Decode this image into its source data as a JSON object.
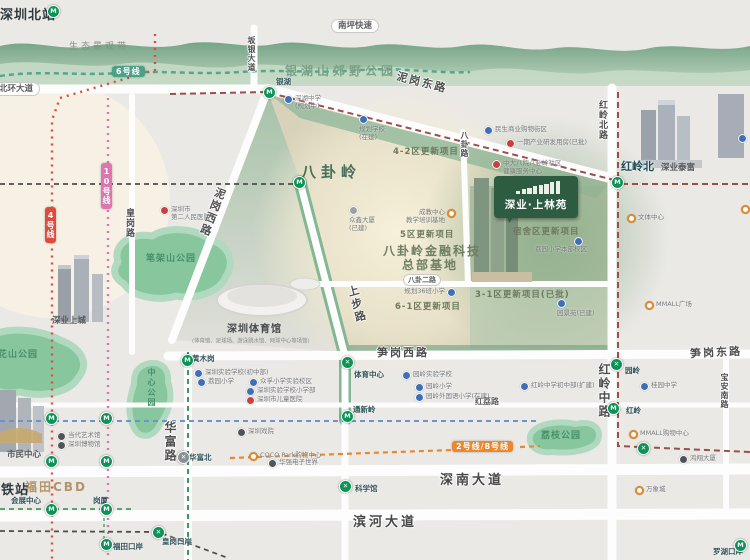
{
  "banner": {
    "title": "深业·上林苑"
  },
  "icons": {
    "glyphs": {
      "m": "M",
      "x": "✕",
      "xg": "✕"
    }
  },
  "badges": [
    {
      "name": "line-6-badge",
      "label": "6号线",
      "x": 112,
      "y": 66,
      "bg": "#4aa183",
      "vert": false
    },
    {
      "name": "line-4-badge",
      "label": "4号线",
      "x": 45,
      "y": 207,
      "bg": "#df4b3d",
      "vert": true
    },
    {
      "name": "line-10-badge",
      "label": "10号线",
      "x": 101,
      "y": 163,
      "bg": "#dd76b0",
      "vert": true
    },
    {
      "name": "line-2-8-badge",
      "label": "2号线/8号线",
      "x": 452,
      "y": 441,
      "bg": "#e8882f",
      "vert": false
    }
  ],
  "labels": [
    {
      "name": "road-nanping-expressway",
      "label": "南坪快速",
      "x": 331,
      "y": 19,
      "cls": "cap"
    },
    {
      "name": "road-beihuan-avenue",
      "label": "北环大道",
      "x": -8,
      "y": 82,
      "cls": "cap"
    },
    {
      "name": "road-banyin-avenue",
      "label": "坂银大道",
      "x": 246,
      "y": 36,
      "cls": "rv rvsm"
    },
    {
      "name": "road-nigang-east",
      "label": "泥岗东路",
      "x": 396,
      "y": 74,
      "cls": "rbig rotNE"
    },
    {
      "name": "road-nigang-west",
      "label": "泥岗西路",
      "x": 204,
      "y": 186,
      "cls": "rbig rotNW"
    },
    {
      "name": "road-huanggang",
      "label": "皇岗路",
      "x": 123,
      "y": 208,
      "cls": "rv"
    },
    {
      "name": "road-hongling-north",
      "label": "红岭北路",
      "x": 596,
      "y": 100,
      "cls": "rv"
    },
    {
      "name": "road-bagua",
      "label": "八卦路",
      "x": 459,
      "y": 131,
      "cls": "rv rvsm"
    },
    {
      "name": "road-bagua-2nd",
      "label": "八卦二路",
      "x": 403,
      "y": 274,
      "cls": "cap capsm"
    },
    {
      "name": "road-shangbu",
      "label": "上步路",
      "x": 348,
      "y": 285,
      "cls": "rbig rotSB"
    },
    {
      "name": "road-sungang-west",
      "label": "笋岗西路",
      "x": 377,
      "y": 344,
      "cls": "rbig"
    },
    {
      "name": "road-sungang-east",
      "label": "笋岗东路",
      "x": 690,
      "y": 344,
      "cls": "rbig rotm3"
    },
    {
      "name": "road-huafu",
      "label": "华富路",
      "x": 162,
      "y": 421,
      "cls": "rv rvbig"
    },
    {
      "name": "road-hongli",
      "label": "红荔路",
      "x": 475,
      "y": 396,
      "cls": "rsm"
    },
    {
      "name": "road-hongling-middle",
      "label": "红岭中路",
      "x": 596,
      "y": 363,
      "cls": "rv rvbig"
    },
    {
      "name": "road-baoan-south",
      "label": "宝安南路",
      "x": 719,
      "y": 373,
      "cls": "rv rvsm"
    },
    {
      "name": "road-shennan-avenue",
      "label": "深南大道",
      "x": 440,
      "y": 469,
      "cls": "rbig rxl"
    },
    {
      "name": "road-binhe-avenue",
      "label": "滨河大道",
      "x": 353,
      "y": 511,
      "cls": "rbig rxl"
    },
    {
      "name": "shenzhen-north-station",
      "label": "深圳北站",
      "x": 0,
      "y": 4,
      "cls": "citybig"
    },
    {
      "name": "eco-landscape-belt",
      "label": "生态景观带",
      "x": 69,
      "y": 39,
      "cls": "eco"
    },
    {
      "name": "yinhushan-country-park",
      "label": "银湖山郊野公园",
      "x": 285,
      "y": 62,
      "cls": "parkbig"
    },
    {
      "name": "bagualing-area",
      "label": "八卦岭",
      "x": 301,
      "y": 161,
      "cls": "areabig"
    },
    {
      "name": "project-4-2",
      "label": "4-2区更新项目",
      "x": 393,
      "y": 145,
      "cls": "areamd"
    },
    {
      "name": "project-5",
      "label": "5区更新项目",
      "x": 400,
      "y": 228,
      "cls": "areamd"
    },
    {
      "name": "fintech-base-line1",
      "label": "八卦岭金融科技",
      "x": 383,
      "y": 242,
      "cls": "arealg"
    },
    {
      "name": "fintech-base-line2",
      "label": "总部基地",
      "x": 402,
      "y": 256,
      "cls": "arealg"
    },
    {
      "name": "project-6-1",
      "label": "6-1区更新项目",
      "x": 395,
      "y": 300,
      "cls": "areamd"
    },
    {
      "name": "project-3-1",
      "label": "3-1区更新项目(已批)",
      "x": 475,
      "y": 288,
      "cls": "areamd"
    },
    {
      "name": "project-dorm",
      "label": "宿舍区更新项目",
      "x": 513,
      "y": 225,
      "cls": "areamd"
    },
    {
      "name": "bijiashan-park",
      "label": "笔架山公园",
      "x": 146,
      "y": 251,
      "cls": "parkmd"
    },
    {
      "name": "lianhuashan-park",
      "label": "莲花山公园",
      "x": -12,
      "y": 347,
      "cls": "parkmd"
    },
    {
      "name": "central-park",
      "label": "中心公园",
      "x": 146,
      "y": 368,
      "cls": "parkv"
    },
    {
      "name": "lizhi-park",
      "label": "荔枝公园",
      "x": 541,
      "y": 428,
      "cls": "parkmd"
    },
    {
      "name": "shenye-upperhills",
      "label": "深业上城",
      "x": 52,
      "y": 314,
      "cls": "bld"
    },
    {
      "name": "shenzhen-gymnasium",
      "label": "深圳体育馆",
      "x": 227,
      "y": 320,
      "cls": "bldlg"
    },
    {
      "name": "gymnasium-sub",
      "label": "(体育馆、足球场、游泳跳水馆、网球中心等场馆)",
      "x": 192,
      "y": 336,
      "cls": "tinysub"
    },
    {
      "name": "futian-cbd",
      "label": "福田CBD",
      "x": 25,
      "y": 478,
      "cls": "cbd"
    },
    {
      "name": "hsr-station",
      "label": "高铁站",
      "x": -13,
      "y": 479,
      "cls": "citybig"
    },
    {
      "name": "civic-center",
      "label": "市民中心",
      "x": 7,
      "y": 448,
      "cls": "bld"
    },
    {
      "name": "shenye-taifu",
      "label": "深业泰富",
      "x": 661,
      "y": 161,
      "cls": "bld"
    },
    {
      "name": "station-honglingbei",
      "label": "红岭北",
      "x": 621,
      "y": 158,
      "cls": "stnbig"
    },
    {
      "name": "station-yinhu",
      "label": "银湖",
      "x": 276,
      "y": 76,
      "cls": "stn"
    },
    {
      "name": "station-huangmugang",
      "label": "黄木岗",
      "x": 192,
      "y": 353,
      "cls": "stn"
    },
    {
      "name": "station-tiyuzhongxin",
      "label": "体育中心",
      "x": 354,
      "y": 369,
      "cls": "stn"
    },
    {
      "name": "station-tongxinling",
      "label": "通新岭",
      "x": 353,
      "y": 404,
      "cls": "stn"
    },
    {
      "name": "station-kexueguan",
      "label": "科学馆",
      "x": 355,
      "y": 483,
      "cls": "stn"
    },
    {
      "name": "station-huafubei",
      "label": "华富北",
      "x": 189,
      "y": 452,
      "cls": "stn"
    },
    {
      "name": "station-yuanling",
      "label": "园岭",
      "x": 625,
      "y": 365,
      "cls": "stn"
    },
    {
      "name": "station-hongling",
      "label": "红岭",
      "x": 626,
      "y": 405,
      "cls": "stn"
    },
    {
      "name": "station-huizhanzhongxin",
      "label": "会展中心",
      "x": 11,
      "y": 495,
      "cls": "stn"
    },
    {
      "name": "station-gangxia",
      "label": "岗厦",
      "x": 93,
      "y": 495,
      "cls": "stn"
    },
    {
      "name": "station-futiankouan",
      "label": "福田口岸",
      "x": 113,
      "y": 541,
      "cls": "stn"
    },
    {
      "name": "station-huanggangkouan",
      "label": "皇岗口岸",
      "x": 162,
      "y": 536,
      "cls": "stn"
    },
    {
      "name": "station-luohukouan",
      "label": "罗湖口岸",
      "x": 713,
      "y": 546,
      "cls": "stn"
    }
  ],
  "station_icons": [
    {
      "name": "icon-shenzhenbei",
      "x": 47,
      "y": 5,
      "type": "m"
    },
    {
      "name": "icon-yinhu",
      "x": 263,
      "y": 86,
      "type": "m"
    },
    {
      "name": "icon-bagualing",
      "x": 293,
      "y": 176,
      "type": "m"
    },
    {
      "name": "icon-honglingbei",
      "x": 611,
      "y": 176,
      "type": "m"
    },
    {
      "name": "icon-yuanling",
      "x": 610,
      "y": 358,
      "type": "x"
    },
    {
      "name": "icon-hongling",
      "x": 607,
      "y": 402,
      "type": "m"
    },
    {
      "name": "icon-huangmugang",
      "x": 181,
      "y": 354,
      "type": "m"
    },
    {
      "name": "icon-tiyuzhongxin",
      "x": 341,
      "y": 356,
      "type": "x"
    },
    {
      "name": "icon-tongxinling",
      "x": 341,
      "y": 410,
      "type": "m"
    },
    {
      "name": "icon-kexueguan",
      "x": 339,
      "y": 480,
      "type": "x"
    },
    {
      "name": "icon-huafubei",
      "x": 177,
      "y": 451,
      "type": "xg"
    },
    {
      "name": "icon-huizhan",
      "x": 45,
      "y": 503,
      "type": "m"
    },
    {
      "name": "icon-gangxia",
      "x": 100,
      "y": 503,
      "type": "m"
    },
    {
      "name": "icon-futiankouan",
      "x": 100,
      "y": 538,
      "type": "m"
    },
    {
      "name": "icon-huanggangkouan",
      "x": 152,
      "y": 526,
      "type": "x"
    },
    {
      "name": "icon-luohukouan",
      "x": 734,
      "y": 539,
      "type": "m"
    },
    {
      "name": "icon-line4-a",
      "x": 45,
      "y": 412,
      "type": "m"
    },
    {
      "name": "icon-line10-a",
      "x": 100,
      "y": 412,
      "type": "m"
    },
    {
      "name": "icon-line4-b",
      "x": 45,
      "y": 455,
      "type": "m"
    },
    {
      "name": "icon-line10-b",
      "x": 100,
      "y": 455,
      "type": "m"
    },
    {
      "name": "icon-hongli-cross",
      "x": 637,
      "y": 442,
      "type": "x"
    }
  ],
  "pois": [
    {
      "name": "poi-hospital-no2",
      "x": 160,
      "y": 206,
      "c": "red",
      "label": "深圳市",
      "l2": "第二人民医院"
    },
    {
      "name": "poi-shenhu-school",
      "x": 284,
      "y": 95,
      "c": "blue",
      "label": "深湖中学",
      "l2": "(规划中)"
    },
    {
      "name": "poi-planned-school",
      "x": 359,
      "y": 115,
      "c": "blue",
      "label": "规划学校",
      "l2": "(在建)",
      "side": "B"
    },
    {
      "name": "poi-minsheng-mall",
      "x": 484,
      "y": 126,
      "c": "blue",
      "label": "民生商业购物街区"
    },
    {
      "name": "poi-phase1-rd",
      "x": 506,
      "y": 139,
      "c": "red",
      "label": "一期产业研发用房(已批)"
    },
    {
      "name": "poi-zhongda-clinic",
      "x": 492,
      "y": 160,
      "c": "red",
      "label": "中大八院八卦岭社区",
      "l2": "健康服务中心"
    },
    {
      "name": "poi-zhongxin-tower",
      "x": 349,
      "y": 206,
      "c": "grey",
      "label": "众鑫大厦",
      "l2": "(已建)",
      "side": "B"
    },
    {
      "name": "poi-training-base",
      "x": 447,
      "y": 209,
      "c": "orange",
      "label": "成教中心",
      "l2": "教学培训基地",
      "side": "L"
    },
    {
      "name": "poi-planned-primary36",
      "x": 447,
      "y": 288,
      "c": "blue",
      "label": "规划36班小学",
      "side": "L"
    },
    {
      "name": "poi-liyuan-main",
      "x": 574,
      "y": 237,
      "c": "blue",
      "label": "荔园小学本部校区",
      "side": "BL"
    },
    {
      "name": "poi-yuanjingyuan",
      "x": 557,
      "y": 299,
      "c": "blue",
      "label": "园景苑(已建)",
      "side": "B"
    },
    {
      "name": "poi-exp-junior",
      "x": 194,
      "y": 369,
      "c": "blue",
      "label": "深圳实验学校(初中部)"
    },
    {
      "name": "poi-liyuan-primary",
      "x": 197,
      "y": 378,
      "c": "blue",
      "label": "荔园小学"
    },
    {
      "name": "poi-zhongfu-primary",
      "x": 249,
      "y": 378,
      "c": "blue",
      "label": "众孚小学实验校区"
    },
    {
      "name": "poi-exp-primary",
      "x": 246,
      "y": 387,
      "c": "blue",
      "label": "深圳实验学校小学部"
    },
    {
      "name": "poi-children-hospital",
      "x": 246,
      "y": 396,
      "c": "red",
      "label": "深圳市儿童医院"
    },
    {
      "name": "poi-yuanling-exp",
      "x": 402,
      "y": 371,
      "c": "blue",
      "label": "园岭实验学校"
    },
    {
      "name": "poi-yuanling-primary",
      "x": 415,
      "y": 383,
      "c": "blue",
      "label": "园岭小学"
    },
    {
      "name": "poi-yuanling-fl",
      "x": 415,
      "y": 393,
      "c": "blue",
      "label": "园岭外国语小学(在建)"
    },
    {
      "name": "poi-hongling-junior",
      "x": 520,
      "y": 382,
      "c": "blue",
      "label": "红岭中学初中部(扩建)"
    },
    {
      "name": "poi-guiyuan-middle",
      "x": 640,
      "y": 382,
      "c": "blue",
      "label": "桂园中学"
    },
    {
      "name": "poi-wenti-center",
      "x": 627,
      "y": 214,
      "c": "orange",
      "label": "文体中心"
    },
    {
      "name": "poi-mmall-plaza",
      "x": 645,
      "y": 301,
      "c": "orange",
      "label": "MMALL广场"
    },
    {
      "name": "poi-mmall-shopping",
      "x": 629,
      "y": 430,
      "c": "orange",
      "label": "MMALL购物中心"
    },
    {
      "name": "poi-mixc",
      "x": 635,
      "y": 486,
      "c": "orange",
      "label": "万象城"
    },
    {
      "name": "poi-hongxiang-tower",
      "x": 679,
      "y": 455,
      "c": "dark",
      "label": "鸿翔大厦"
    },
    {
      "name": "poi-coco-park",
      "x": 249,
      "y": 452,
      "c": "orange",
      "label": "COCO Park购物中心"
    },
    {
      "name": "poi-hq-electronics",
      "x": 268,
      "y": 459,
      "c": "dark",
      "label": "华强电子世界"
    },
    {
      "name": "poi-theatre",
      "x": 237,
      "y": 428,
      "c": "dark",
      "label": "深圳戏院"
    },
    {
      "name": "poi-moca",
      "x": 57,
      "y": 432,
      "c": "dark",
      "label": "当代艺术馆"
    },
    {
      "name": "poi-museum",
      "x": 57,
      "y": 441,
      "c": "dark",
      "label": "深圳博物馆"
    },
    {
      "name": "poi-edge-1",
      "x": 738,
      "y": 134,
      "c": "blue",
      "label": ""
    },
    {
      "name": "poi-edge-2",
      "x": 741,
      "y": 205,
      "c": "orange",
      "label": ""
    }
  ]
}
